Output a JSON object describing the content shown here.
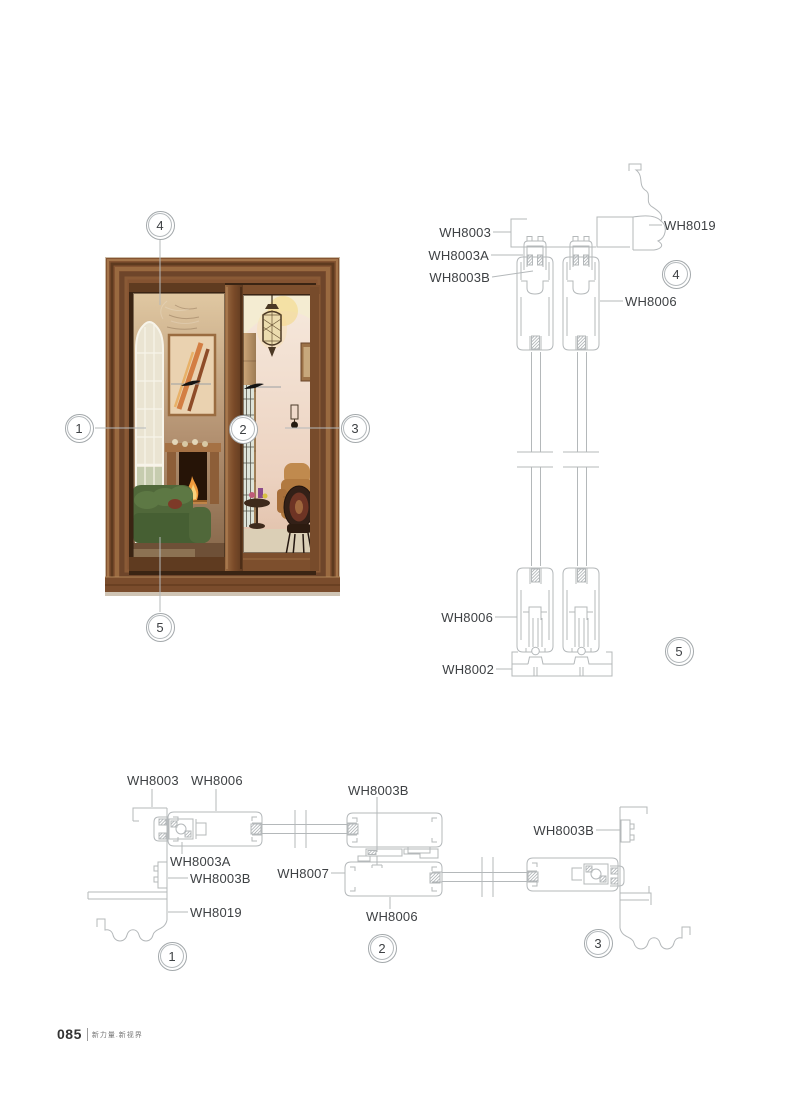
{
  "footer": {
    "page_number": "085",
    "tagline": "新力量.新视界"
  },
  "door_callouts": {
    "c1": "1",
    "c2": "2",
    "c3": "3",
    "c4": "4",
    "c5": "5"
  },
  "vertical_section": {
    "callouts": {
      "c4": "4",
      "c5": "5"
    },
    "labels": {
      "wh8003": "WH8003",
      "wh8003a": "WH8003A",
      "wh8003b": "WH8003B",
      "wh8019": "WH8019",
      "wh8006_top": "WH8006",
      "wh8006_bottom": "WH8006",
      "wh8002": "WH8002"
    }
  },
  "horizontal_section": {
    "callouts": {
      "c1": "1",
      "c2": "2",
      "c3": "3"
    },
    "labels": {
      "wh8003": "WH8003",
      "wh8006_left": "WH8006",
      "wh8003a": "WH8003A",
      "wh8003b_left": "WH8003B",
      "wh8019": "WH8019",
      "wh8007": "WH8007",
      "wh8003b_mid": "WH8003B",
      "wh8006_mid": "WH8006",
      "wh8003b_right": "WH8003B"
    }
  },
  "colors": {
    "diagram_line": "#b4b8ba",
    "label_text": "#3e4144",
    "callout_ring": "#a3a8ab",
    "wood_frame": "#7a4a28"
  }
}
